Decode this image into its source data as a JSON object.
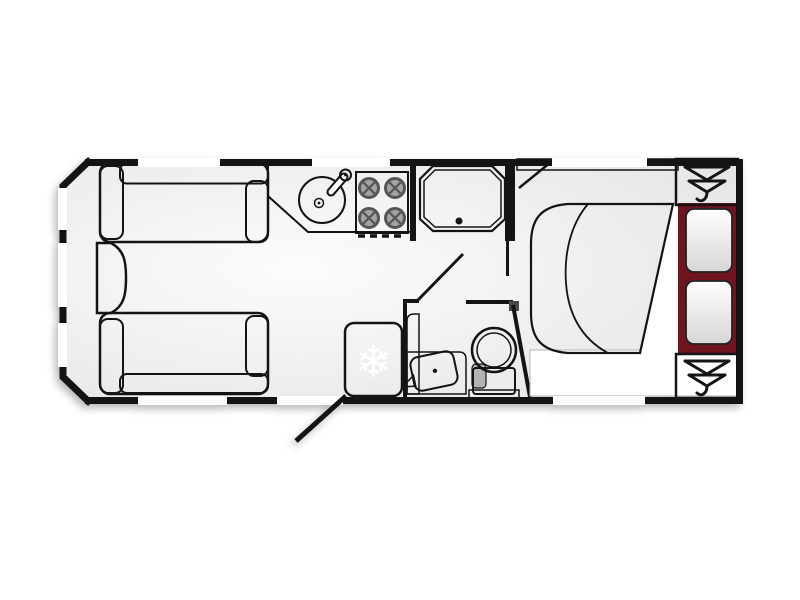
{
  "plan": {
    "title": "caravan-floorplan",
    "lounge": {
      "sofa_top": "front-sofa",
      "sofa_bottom": "front-sofa",
      "chest": "front-chest"
    },
    "kitchen": {
      "sink": "round-sink-with-tap",
      "hob": "four-burner-hob"
    },
    "washroom": {
      "shower": "shower-tray",
      "toilet": "toilet",
      "basin": "corner-vanity-basin"
    },
    "fridge": {
      "label": "fridge",
      "icon_glyph": "❄"
    },
    "bedroom": {
      "bed": "transverse-double-bed",
      "pillow_count": 2,
      "wardrobe_count": 2
    },
    "openings": {
      "windows_top": 3,
      "windows_bottom": 2,
      "windows_front": 3,
      "entrance_door": "open"
    }
  },
  "colors": {
    "wall": "#141414",
    "floor_light": "#fcfcfc",
    "floor_dark": "#e3e3e3",
    "sofa_mid": "#a82634",
    "sofa_backrest": "#8f1b26",
    "bed_base": "#6e1520",
    "wood": "#d2bfa3",
    "hob": "#8f8f8f",
    "burner": "#5f5f5f",
    "white": "#ffffff"
  }
}
